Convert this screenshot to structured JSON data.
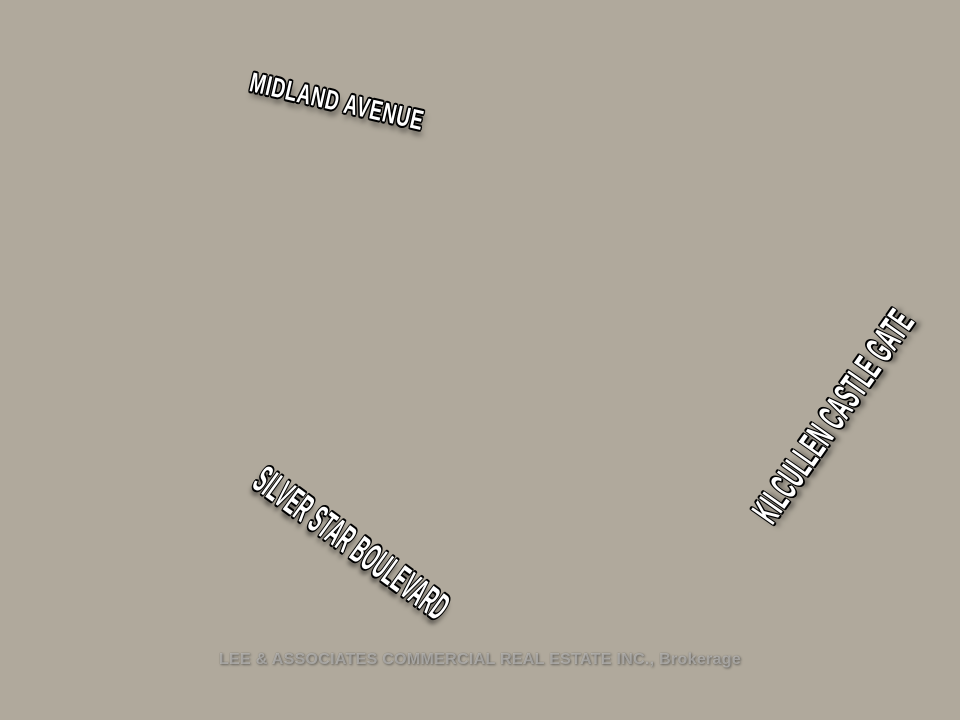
{
  "labels": {
    "street_top": "MIDLAND AVENUE",
    "street_left": "SILVER STAR BOULEVARD",
    "street_right": "KILCULLEN CASTLE GATE"
  },
  "watermark": "LEE & ASSOCIATES COMMERCIAL REAL ESTATE INC., Brokerage",
  "colors": {
    "parcel_outline": "#ab1f33",
    "label_text": "#ffffff",
    "label_outline": "#000000",
    "watermark_text": "rgba(230,230,230,0.5)"
  }
}
